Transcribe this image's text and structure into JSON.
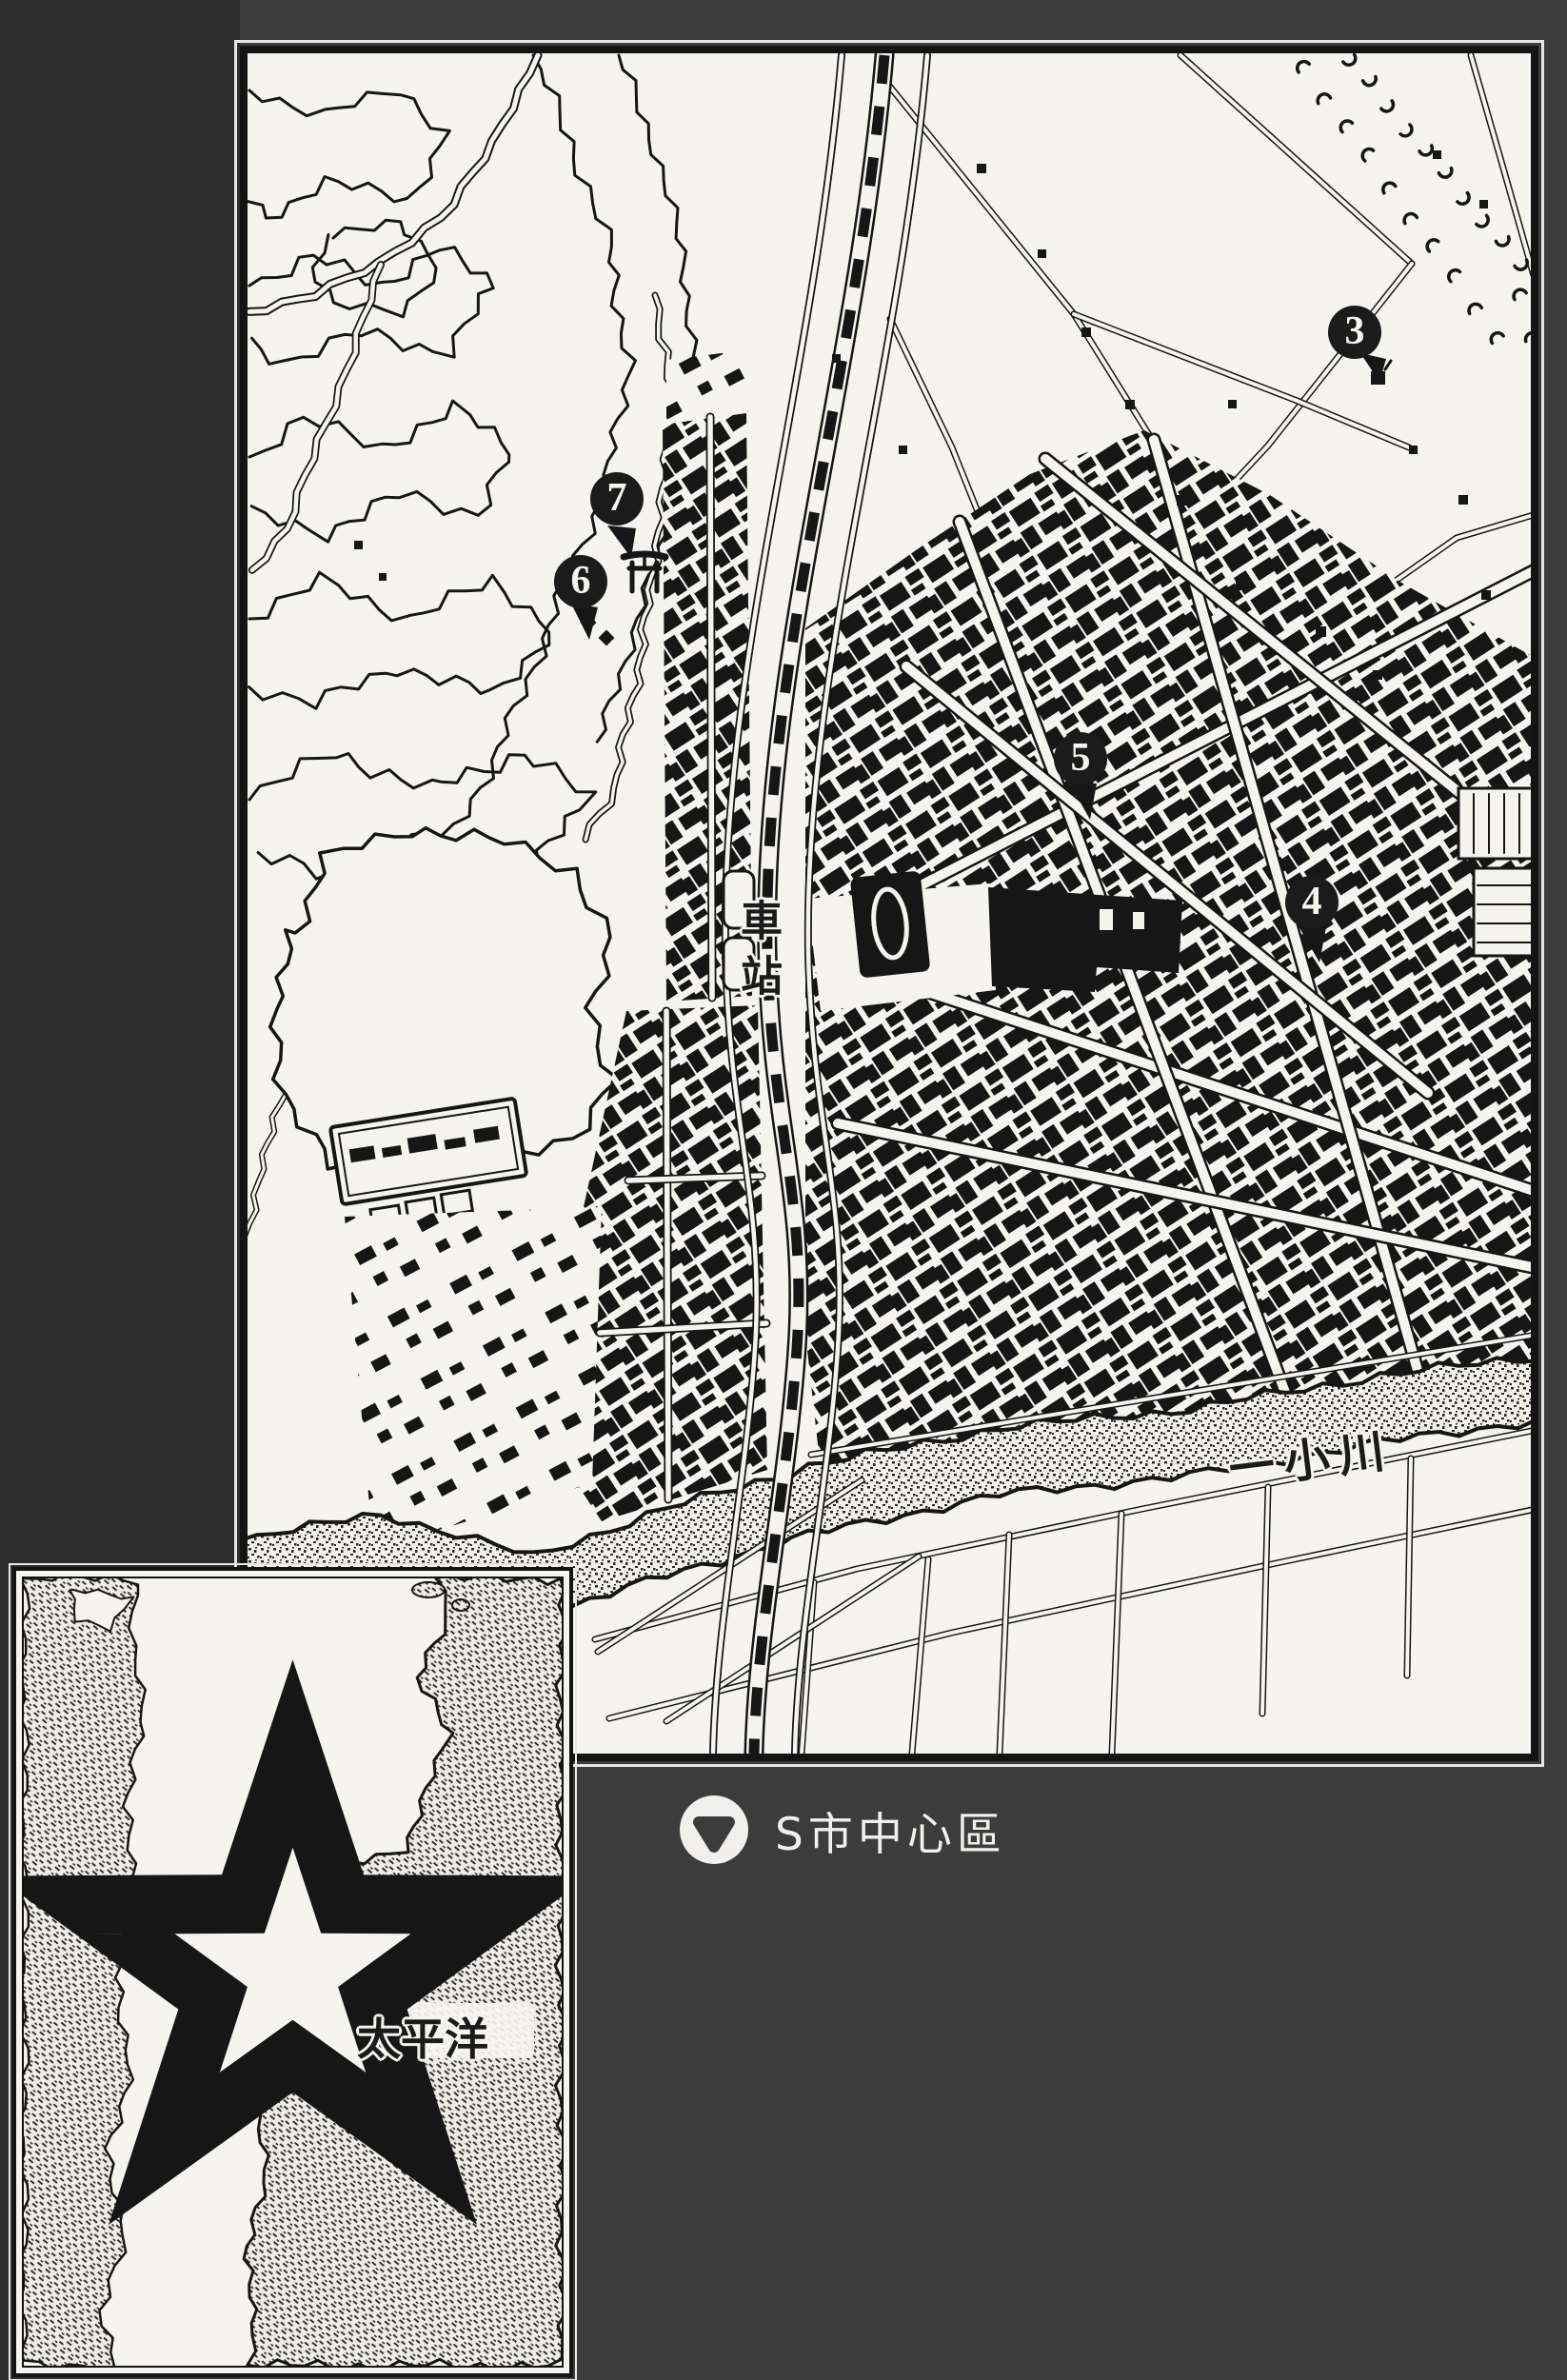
{
  "colors": {
    "paper": "#f6f4ef",
    "ink": "#161616",
    "background": "#3c3c3c",
    "left_strip": "#2e2e2e",
    "label_white": "#f2f0ec"
  },
  "main_map": {
    "station_label": "車站",
    "river_label": "一小川",
    "markers": [
      {
        "number": "3"
      },
      {
        "number": "4"
      },
      {
        "number": "5"
      },
      {
        "number": "6"
      },
      {
        "number": "7"
      }
    ],
    "icons": {
      "shrine": "torii-icon",
      "coast_hatching": "cliff-hatch-marks"
    }
  },
  "caption": {
    "icon": "down-triangle-circle-icon",
    "text": "S市中心區"
  },
  "inset_map": {
    "city_label": "S市",
    "city_marker": "star-icon",
    "ocean_label": "太平洋"
  }
}
